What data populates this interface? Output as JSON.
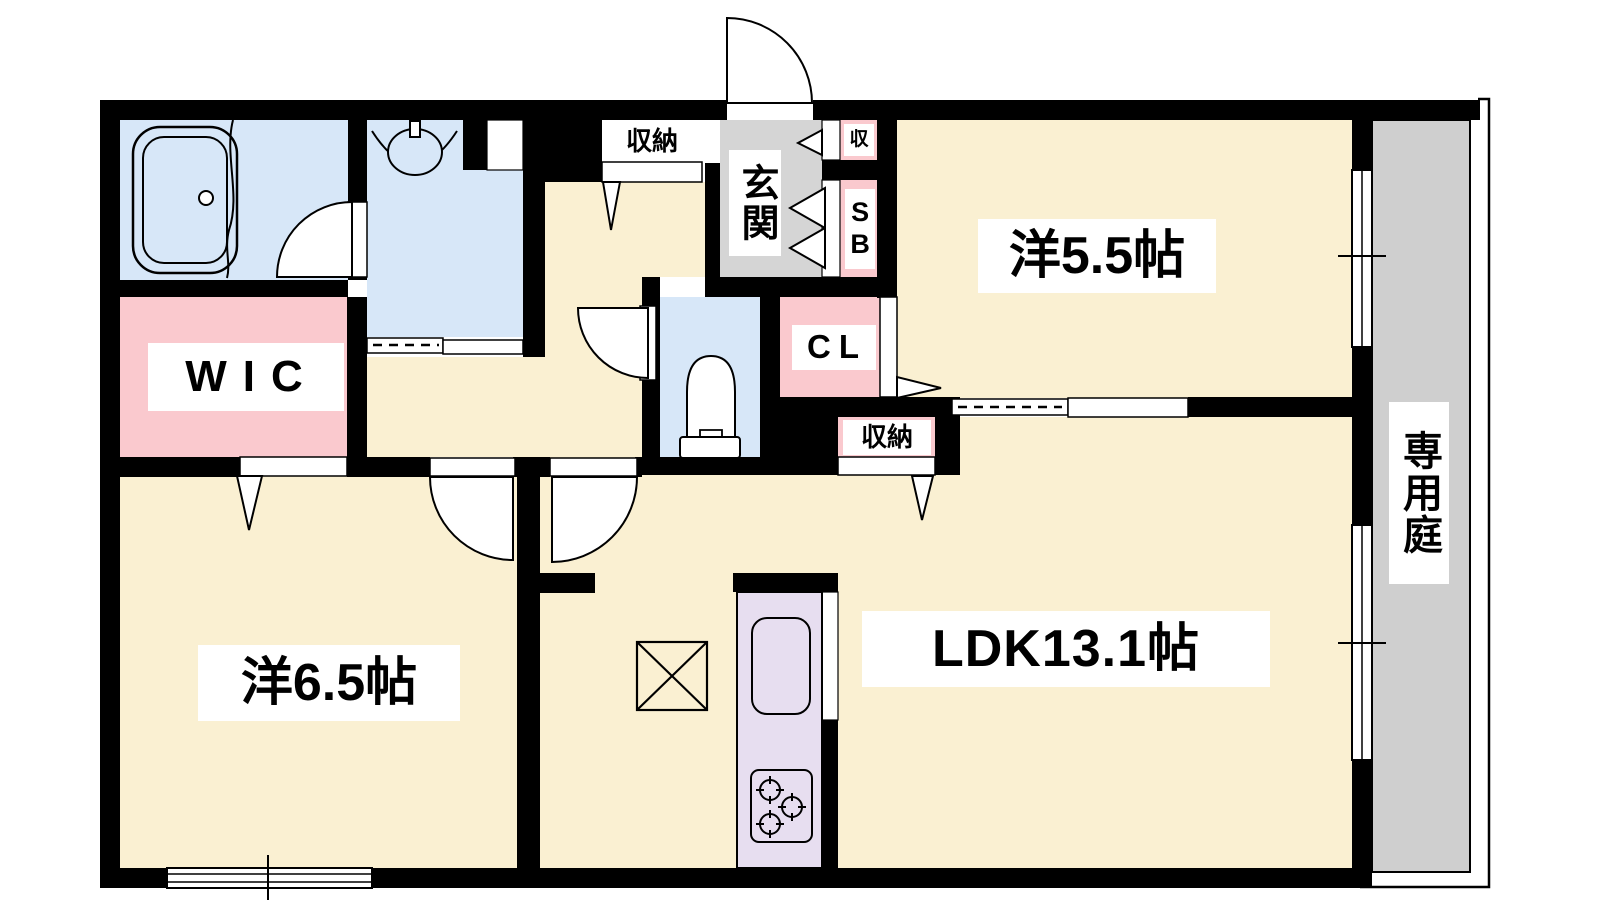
{
  "floorplan": {
    "rooms": {
      "bedroom_55": {
        "label": "洋5.5帖"
      },
      "bedroom_65": {
        "label": "洋6.5帖"
      },
      "ldk": {
        "label": "LDK13.1帖"
      },
      "wic": {
        "label": "WIC"
      },
      "entrance": {
        "label": "玄関"
      },
      "private_garden": {
        "label": "専用庭"
      },
      "closet": {
        "label": "CL"
      },
      "shoe_box": {
        "label": "SB"
      },
      "storage_hall": {
        "label": "収納"
      },
      "storage_ldk": {
        "label": "収納"
      },
      "storage_entrance": {
        "label": "収"
      }
    },
    "colors": {
      "floor_cream": "#faf0d2",
      "wet_area_blue": "#d7e7f8",
      "storage_pink": "#fac9ce",
      "entrance_gray": "#d5d5d5",
      "garden_gray": "#cfcfcf",
      "kitchen_purple": "#e7def0",
      "wall_black": "#000000"
    },
    "fixtures": [
      "bathtub",
      "washbasin",
      "toilet",
      "kitchen-sink",
      "gas-stove",
      "refrigerator-space"
    ]
  }
}
